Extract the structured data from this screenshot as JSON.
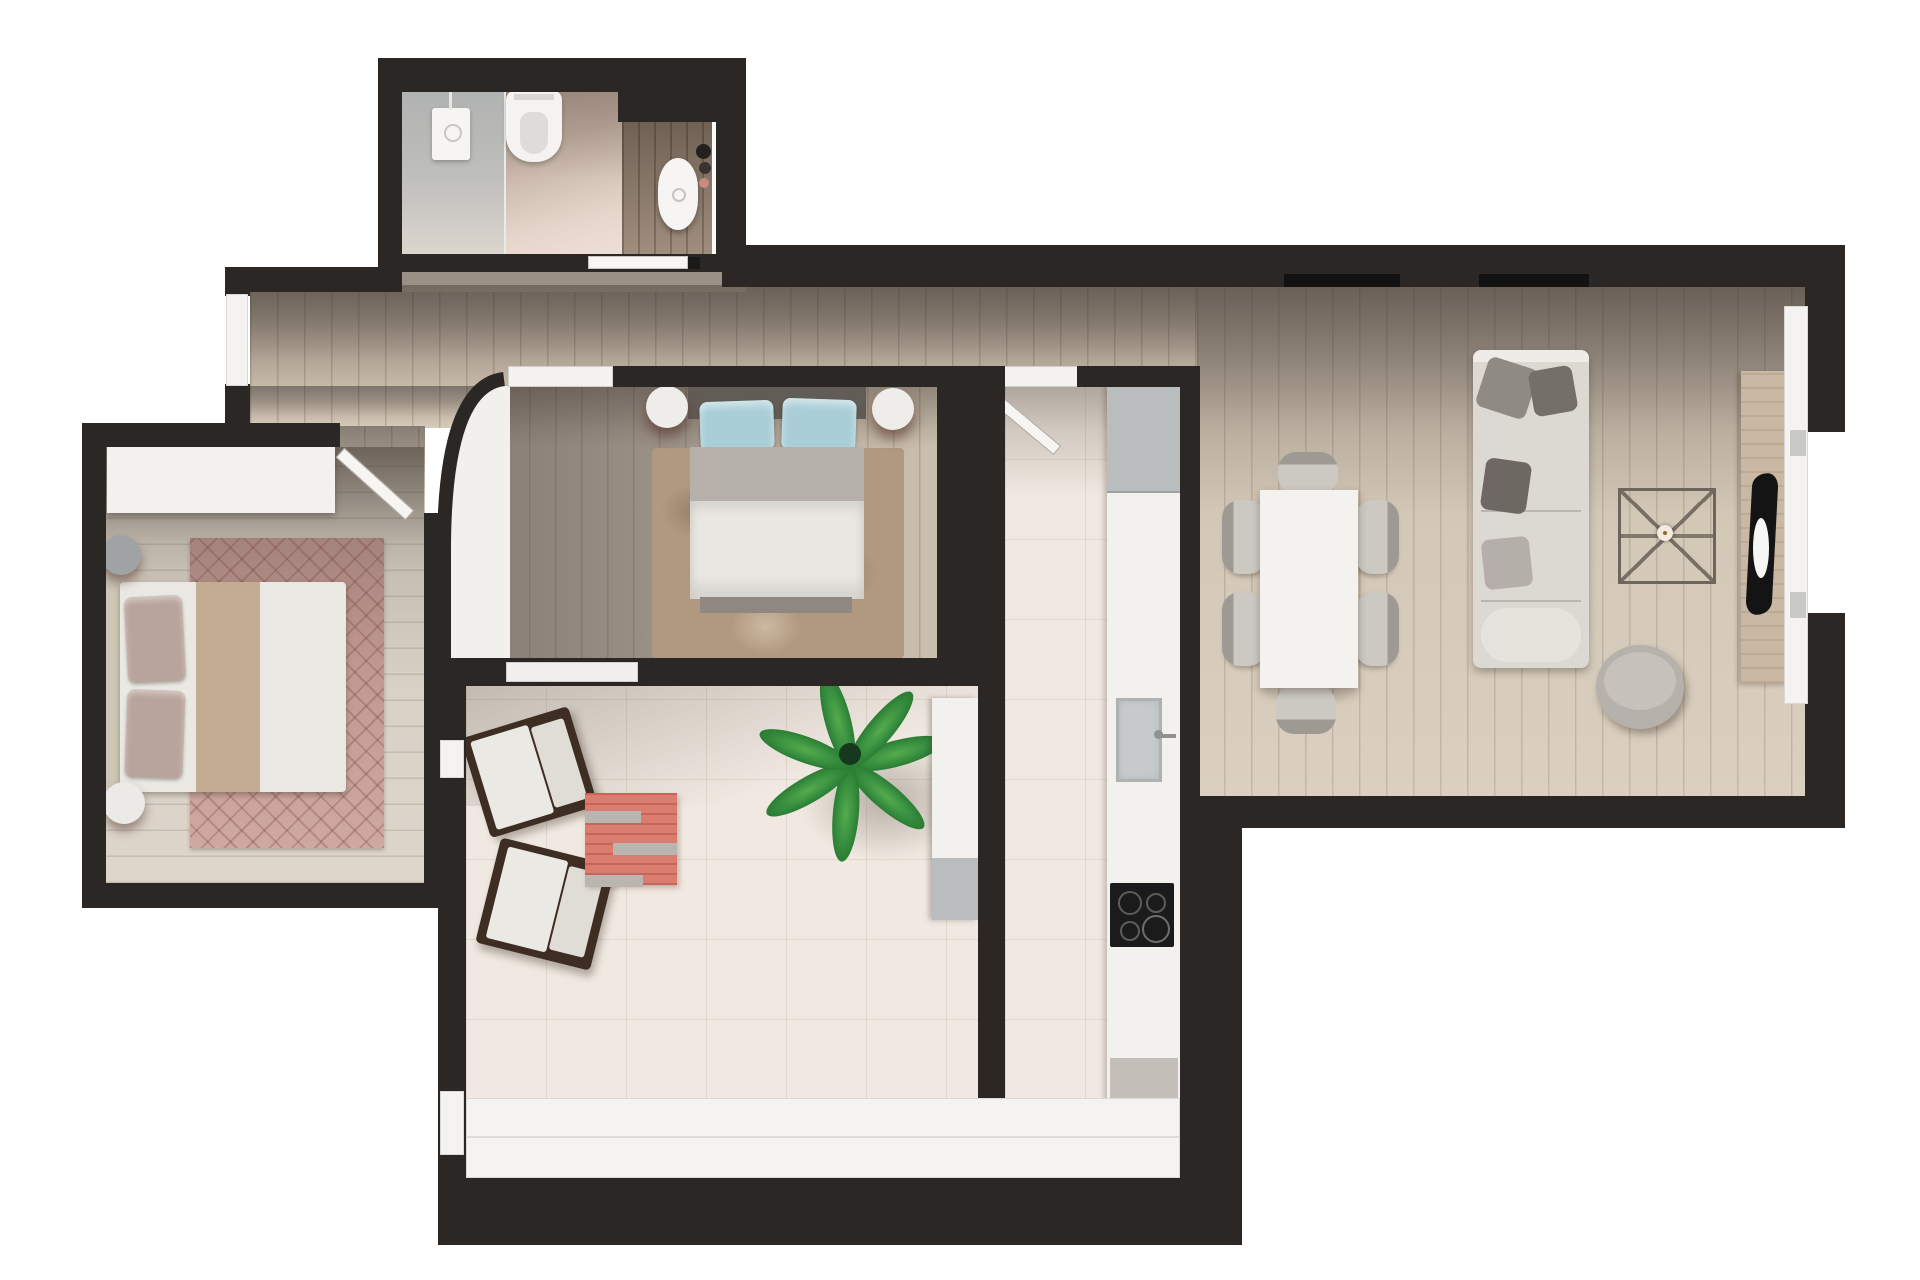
{
  "scene": {
    "type": "3d-rendered floor plan, top-down view",
    "canvas": {
      "width": 1920,
      "height": 1280
    },
    "background": "#ffffff"
  },
  "palette": {
    "exterior": "#ffffff",
    "wall": "#2a2724",
    "window_white": "#f4f3f1",
    "tile": "#f0e9e1",
    "white_furn": "#f3f1ed",
    "gray_fixture": "#b9bdbe",
    "shower_gray": "#b6b8b7",
    "mauve_rug": "#c29a92",
    "shag_rug": "#b1997f",
    "coral_rug": "#db7d6e",
    "blue_pillow": "#a9ced7",
    "plant_green": "#3b9342",
    "sofa_gray": "#dcd8d2",
    "appliance_black": "#1b1b1b",
    "wood_console": "#c9b8a3"
  },
  "rooms": [
    {
      "id": "bathroom",
      "name": "Bathroom",
      "floor": "ceramic tile",
      "furniture": [
        "walk-in shower",
        "wall-hung toilet",
        "wood vanity with oval sink",
        "mirror",
        "sliding door"
      ]
    },
    {
      "id": "hallway",
      "name": "Hallway",
      "floor": "wood planks",
      "furniture": []
    },
    {
      "id": "bedroom-left",
      "name": "Bedroom 1",
      "floor": "wood planks",
      "furniture": [
        "double bed",
        "wardrobe",
        "round nightstand x2",
        "diamond-pattern rug",
        "swing door"
      ]
    },
    {
      "id": "bedroom-middle",
      "name": "Bedroom 2",
      "floor": "wood planks",
      "furniture": [
        "double bed with blue pillows",
        "shaggy rug",
        "round nightstand x2",
        "curved wall",
        "sliding door"
      ]
    },
    {
      "id": "terrace",
      "name": "Terrace lounge",
      "floor": "ceramic tile",
      "furniture": [
        "lounge chair x2",
        "coral striped rug",
        "potted palm",
        "sideboard",
        "panoramic glazing"
      ]
    },
    {
      "id": "kitchen",
      "name": "Kitchen",
      "floor": "ceramic tile",
      "furniture": [
        "counter run",
        "fridge",
        "sink with faucet",
        "induction cooktop",
        "open door"
      ]
    },
    {
      "id": "dining",
      "name": "Dining area",
      "floor": "wood planks",
      "furniture": [
        "rectangular white table",
        "dining chair x6"
      ]
    },
    {
      "id": "living",
      "name": "Living area",
      "floor": "wood planks",
      "furniture": [
        "three-seat sofa with cushions",
        "wireframe coffee table",
        "round pouf",
        "TV sideboard",
        "window wall"
      ]
    }
  ]
}
